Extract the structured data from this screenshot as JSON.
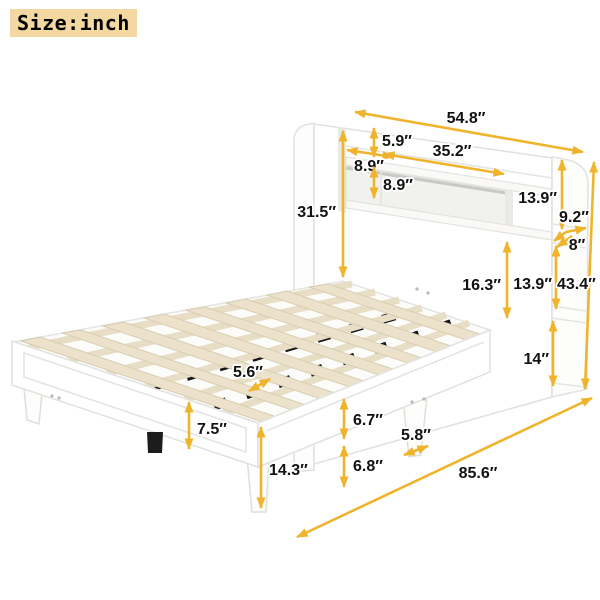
{
  "page": {
    "size_label": "Size:inch",
    "unit": "inch"
  },
  "colors": {
    "arrow": "#f0b42c",
    "label_text": "#121212",
    "label_halo": "#ffffff",
    "size_badge_bg": "#f3d8a2",
    "bed_white": "#ffffff",
    "bed_stroke": "#e2e2df",
    "slat": "#ece2cb",
    "center_support_black": "#1c1c1c"
  },
  "diagram": {
    "subject": "platform-bed-with-storage-headboard",
    "dimensions": [
      {
        "name": "dim-54-8",
        "label": "54.8″",
        "lx": 466,
        "ly": 123,
        "anchor": "middle",
        "lines": [
          [
            355,
            112,
            583,
            152,
            "both"
          ]
        ]
      },
      {
        "name": "dim-5-9",
        "label": "5.9″",
        "lx": 382,
        "ly": 146,
        "anchor": "start",
        "lines": [
          [
            374,
            128,
            374,
            157,
            "both"
          ]
        ]
      },
      {
        "name": "dim-35-2",
        "label": "35.2″",
        "lx": 452,
        "ly": 156,
        "anchor": "middle",
        "lines": [
          [
            384,
            154,
            504,
            174,
            "both"
          ]
        ]
      },
      {
        "name": "dim-8-9-side",
        "label": "8.9″",
        "lx": 369,
        "ly": 171,
        "anchor": "middle",
        "lines": [
          [
            347,
            150,
            393,
            157,
            "both"
          ]
        ]
      },
      {
        "name": "dim-8-9-shelf",
        "label": "8.9″",
        "lx": 383,
        "ly": 190,
        "anchor": "start",
        "lines": [
          [
            374,
            167,
            374,
            198,
            "both"
          ]
        ]
      },
      {
        "name": "dim-31-5",
        "label": "31.5″",
        "lx": 336,
        "ly": 217,
        "anchor": "end",
        "lines": [
          [
            343,
            131,
            343,
            277,
            "both"
          ]
        ]
      },
      {
        "name": "dim-13-9-upper",
        "label": "13.9″",
        "lx": 557,
        "ly": 203,
        "anchor": "end",
        "lines": [
          [
            562,
            160,
            562,
            229,
            "both"
          ]
        ]
      },
      {
        "name": "dim-9-2",
        "label": "9.2″",
        "lx": 574,
        "ly": 222,
        "anchor": "middle",
        "lines": [
          [
            566,
            232,
            586,
            228,
            "end"
          ],
          [
            566,
            232,
            554,
            241,
            "end"
          ]
        ]
      },
      {
        "name": "dim-8-shelf",
        "label": "8″",
        "lx": 577,
        "ly": 250,
        "anchor": "middle",
        "lines": [
          [
            572,
            236,
            557,
            247,
            "end"
          ]
        ]
      },
      {
        "name": "dim-13-9-lower",
        "label": "13.9″",
        "lx": 552,
        "ly": 289,
        "anchor": "end",
        "lines": [
          [
            556,
            246,
            556,
            309,
            "both"
          ]
        ]
      },
      {
        "name": "dim-43-4",
        "label": "43.4″",
        "lx": 557,
        "ly": 289,
        "anchor": "start",
        "lines": [
          [
            594,
            162,
            585,
            389,
            "both"
          ]
        ]
      },
      {
        "name": "dim-14",
        "label": "14″",
        "lx": 549,
        "ly": 364,
        "anchor": "end",
        "lines": [
          [
            553,
            321,
            553,
            386,
            "both"
          ]
        ]
      },
      {
        "name": "dim-16-3",
        "label": "16.3″",
        "lx": 501,
        "ly": 290,
        "anchor": "end",
        "lines": [
          [
            507,
            242,
            507,
            318,
            "both"
          ]
        ]
      },
      {
        "name": "dim-5-6",
        "label": "5.6″",
        "lx": 248,
        "ly": 377,
        "anchor": "middle",
        "lines": [
          [
            249,
            391,
            270,
            379,
            "both"
          ]
        ]
      },
      {
        "name": "dim-7-5",
        "label": "7.5″",
        "lx": 197,
        "ly": 434,
        "anchor": "start",
        "lines": [
          [
            189,
            402,
            189,
            449,
            "both"
          ]
        ]
      },
      {
        "name": "dim-14-3",
        "label": "14.3″",
        "lx": 269,
        "ly": 475,
        "anchor": "start",
        "lines": [
          [
            261,
            427,
            261,
            508,
            "both"
          ]
        ]
      },
      {
        "name": "dim-6-7",
        "label": "6.7″",
        "lx": 353,
        "ly": 425,
        "anchor": "start",
        "lines": [
          [
            344,
            399,
            344,
            439,
            "both"
          ]
        ]
      },
      {
        "name": "dim-6-8",
        "label": "6.8″",
        "lx": 353,
        "ly": 471,
        "anchor": "start",
        "lines": [
          [
            344,
            446,
            344,
            487,
            "both"
          ]
        ]
      },
      {
        "name": "dim-5-8",
        "label": "5.8″",
        "lx": 416,
        "ly": 440,
        "anchor": "middle",
        "lines": [
          [
            404,
            455,
            428,
            446,
            "both"
          ]
        ]
      },
      {
        "name": "dim-85-6",
        "label": "85.6″",
        "lx": 478,
        "ly": 478,
        "anchor": "middle",
        "lines": [
          [
            297,
            537,
            592,
            398,
            "both"
          ]
        ]
      }
    ]
  }
}
